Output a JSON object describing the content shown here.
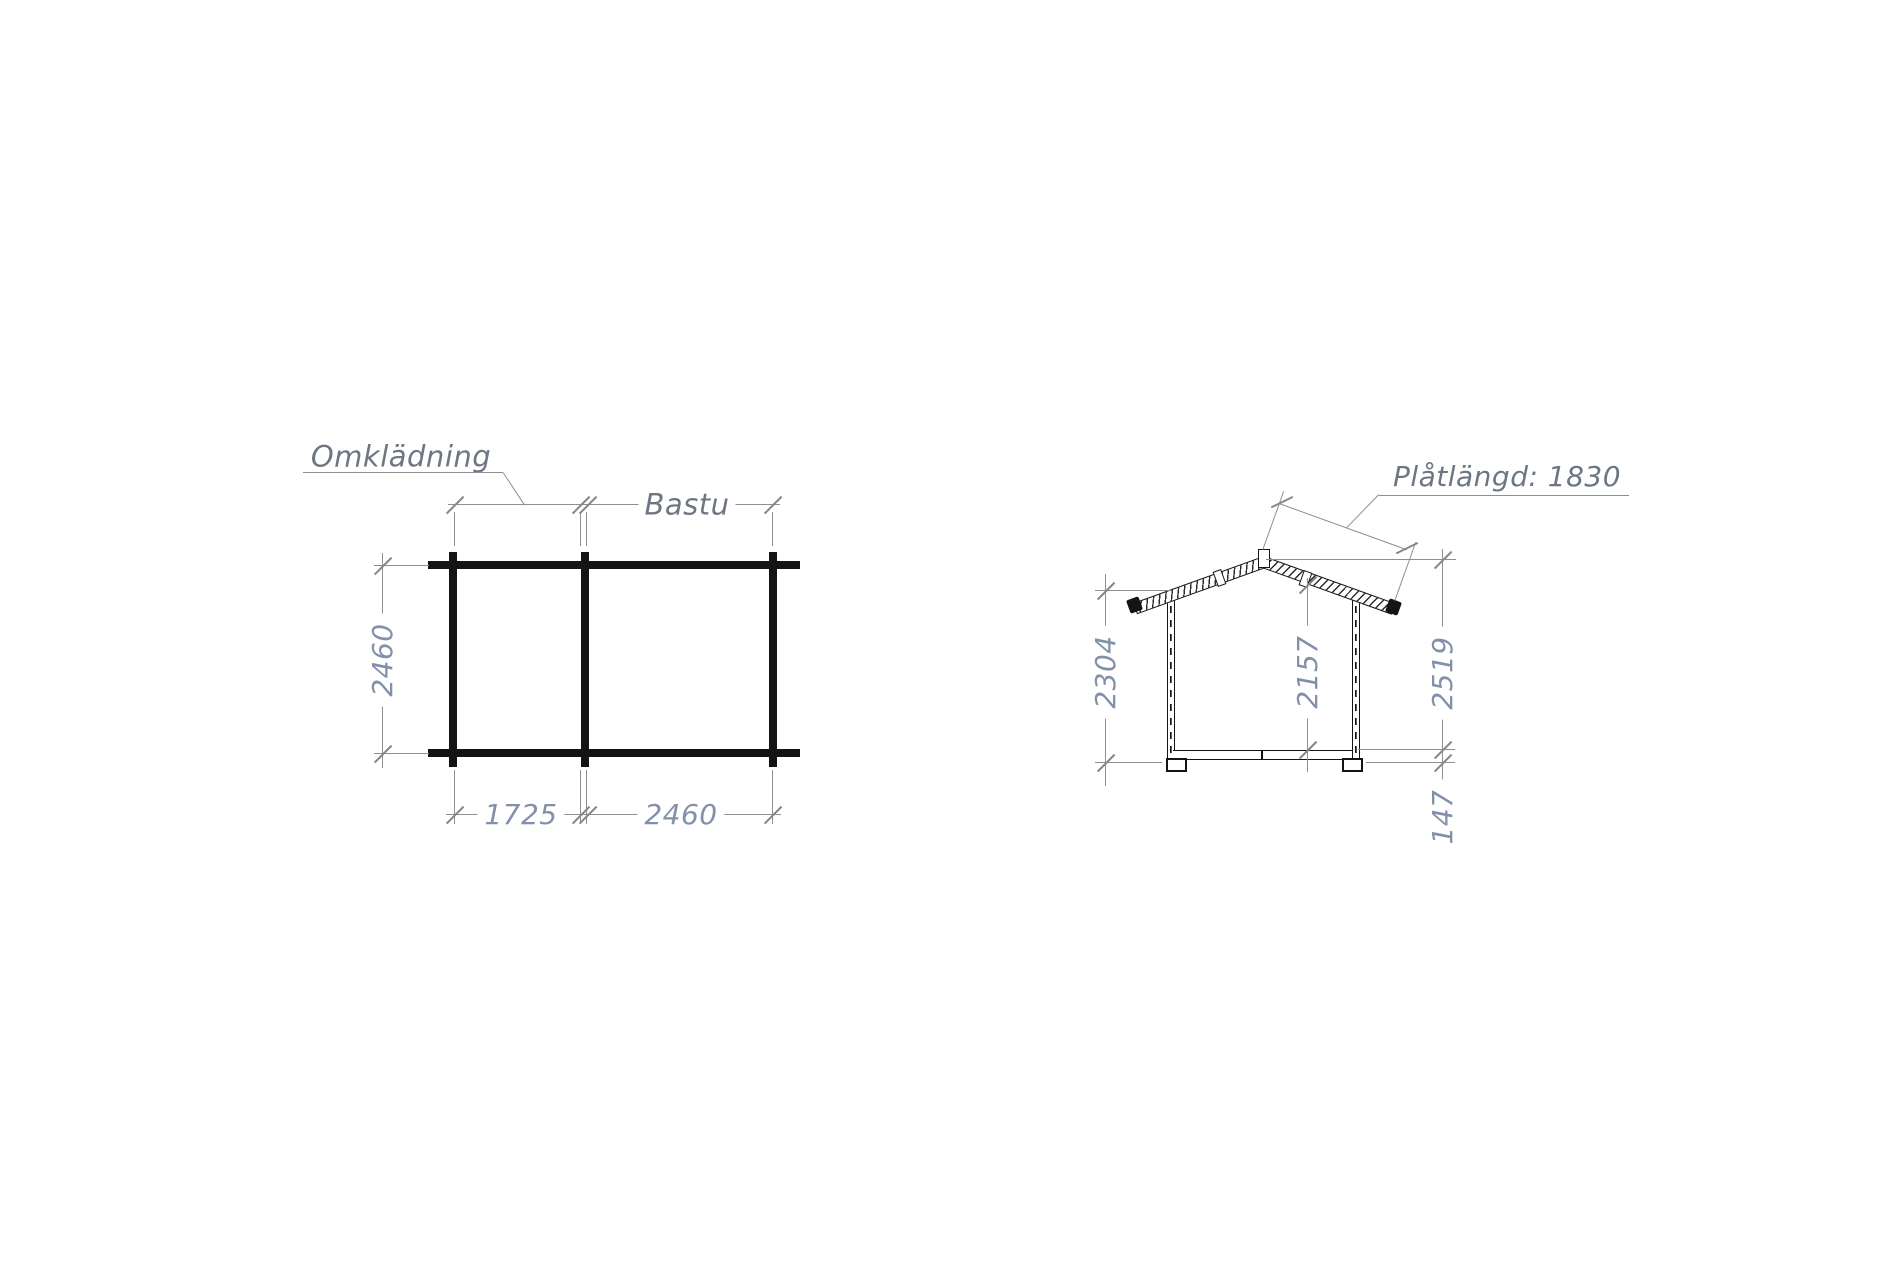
{
  "document": {
    "type": "construction-drawing",
    "views": [
      "floor-plan",
      "gable-elevation"
    ]
  },
  "plan": {
    "room1_label": "Omklädning",
    "room2_label": "Bastu",
    "dim_depth": "2460",
    "dim_width_room1": "1725",
    "dim_width_room2": "2460"
  },
  "elevation": {
    "plate_label": "Plåtlängd: 1830",
    "dim_wall_height": "2304",
    "dim_inner_height": "2157",
    "dim_total_height": "2519",
    "dim_floor_thickness": "147"
  },
  "colors": {
    "background": "#ffffff",
    "drawing_line": "#141414",
    "dimension_line": "#8f8f8f",
    "dimension_text": "#8291a9",
    "label_text": "#6d7683"
  }
}
